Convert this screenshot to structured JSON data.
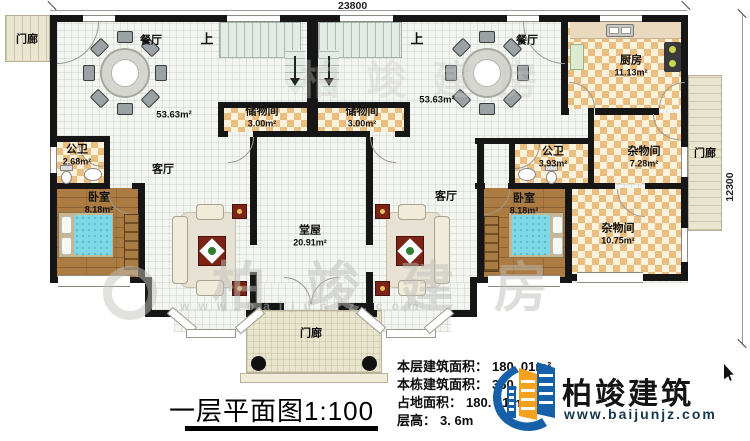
{
  "dims": {
    "top": "23800",
    "right": "12300"
  },
  "rooms": {
    "porch_top_left": {
      "name": "门廊"
    },
    "dining_left": {
      "name": "餐厅",
      "area": "53.63m²"
    },
    "dining_right": {
      "name": "餐厅",
      "area": "53.63m²"
    },
    "up_left": "上",
    "up_right": "上",
    "storage_left": {
      "name": "储物间",
      "area": "3.00m²"
    },
    "storage_right": {
      "name": "储物间",
      "area": "3.00m²"
    },
    "kitchen": {
      "name": "厨房",
      "area": "11.13m²"
    },
    "bath_left": {
      "name": "公卫",
      "area": "2.68m²"
    },
    "bath_right": {
      "name": "公卫",
      "area": "3.93m²"
    },
    "living_left": {
      "name": "客厅"
    },
    "living_right": {
      "name": "客厅"
    },
    "bedroom_left": {
      "name": "卧室",
      "area": "8.18m²"
    },
    "bedroom_right": {
      "name": "卧室",
      "area": "8.18m²"
    },
    "utility_small": {
      "name": "杂物间",
      "area": "7.28m²"
    },
    "utility_large": {
      "name": "杂物间",
      "area": "10.75m²"
    },
    "hall": {
      "name": "堂屋",
      "area": "20.91m²"
    },
    "porch_front": {
      "name": "门廊"
    },
    "porch_right": {
      "name": "门廊"
    }
  },
  "title": {
    "text": "一层平面图",
    "scale": "1:100"
  },
  "stats": {
    "rows": [
      {
        "label": "本层建筑面积：",
        "value": "180. 01m²"
      },
      {
        "label": "本栋建筑面积：",
        "value": "360. 02m²"
      },
      {
        "label": "占地面积：",
        "value": "180. 01m²"
      },
      {
        "label": "层高：",
        "value": "3. 6m"
      }
    ]
  },
  "brand": {
    "name": "柏竣建筑",
    "url": "www.baijunjz.com"
  },
  "watermark": {
    "text": "柏竣建房",
    "url": "www.baijunjz.com"
  },
  "colors": {
    "wall": "#161616",
    "brand_blue": "#1560a8",
    "brand_orange": "#f6a11c",
    "table_red": "#7c2316",
    "bed_blue": "#7fd8e6"
  }
}
